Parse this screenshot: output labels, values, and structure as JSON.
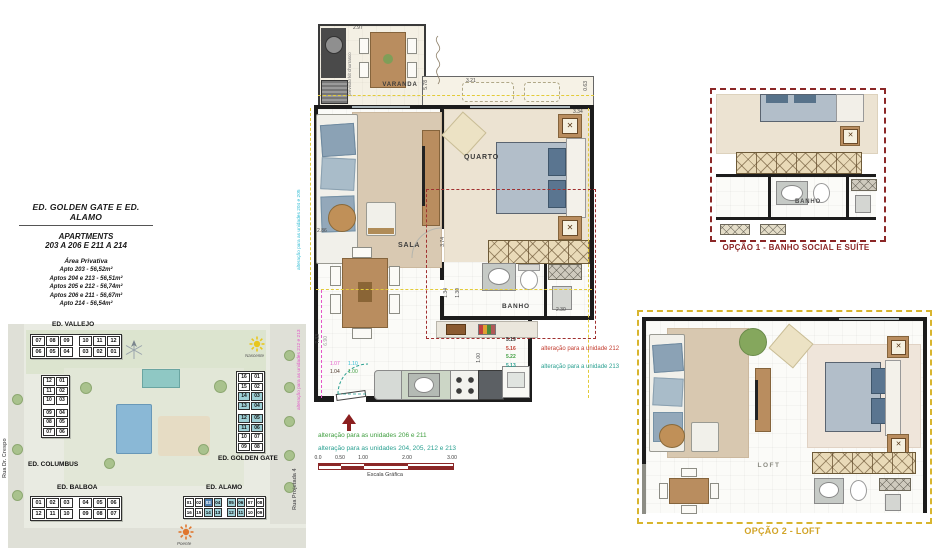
{
  "info_panel": {
    "title": "ED. GOLDEN GATE E ED. ALAMO",
    "subtitle1": "APARTMENTS",
    "subtitle2": "203 A 206 E 211 A 214",
    "area_heading": "Área Privativa",
    "areas": [
      "Apto 203 - 56,52m²",
      "Aptos 204 e 213 - 56,51m²",
      "Aptos 205 e 212 - 56,74m²",
      "Aptos 206 e 211 - 56,67m²",
      "Apto 214 - 56,54m²"
    ]
  },
  "site_map": {
    "street_left": "Rua Dr. Crespo",
    "street_right": "Rua Projetada 4",
    "sun_east": "Nascente",
    "sun_west": "Poente",
    "buildings": {
      "vallejo": {
        "label": "ED. VALLEJO",
        "rows": [
          [
            "07",
            "08",
            "09",
            "10",
            "11",
            "12"
          ],
          [
            "06",
            "05",
            "04",
            "03",
            "02",
            "01"
          ]
        ],
        "hl": [
          [
            0,
            0,
            0,
            0,
            0,
            0
          ],
          [
            0,
            0,
            0,
            0,
            0,
            0
          ]
        ]
      },
      "columbus": {
        "label": "ED. COLUMBUS",
        "pairs": [
          [
            "12",
            "01"
          ],
          [
            "11",
            "02"
          ],
          [
            "10",
            "03"
          ],
          [
            "09",
            "04"
          ],
          [
            "08",
            "05"
          ],
          [
            "07",
            "06"
          ]
        ],
        "hl": [
          [
            0,
            0
          ],
          [
            0,
            0
          ],
          [
            0,
            0
          ],
          [
            0,
            0
          ],
          [
            0,
            0
          ],
          [
            0,
            0
          ]
        ]
      },
      "golden_gate": {
        "label": "ED. GOLDEN GATE",
        "pairs": [
          [
            "16",
            "01"
          ],
          [
            "15",
            "02"
          ],
          [
            "14",
            "03"
          ],
          [
            "13",
            "04"
          ],
          [
            "12",
            "05"
          ],
          [
            "11",
            "06"
          ],
          [
            "10",
            "07"
          ],
          [
            "09",
            "08"
          ]
        ],
        "hl": [
          [
            0,
            0
          ],
          [
            0,
            0
          ],
          [
            1,
            1
          ],
          [
            1,
            1
          ],
          [
            1,
            1
          ],
          [
            1,
            1
          ],
          [
            0,
            0
          ],
          [
            0,
            0
          ]
        ]
      },
      "balboa": {
        "label": "ED. BALBOA",
        "rows": [
          [
            "01",
            "02",
            "03",
            "04",
            "05",
            "06"
          ],
          [
            "12",
            "11",
            "10",
            "09",
            "08",
            "07"
          ]
        ],
        "hl": [
          [
            0,
            0,
            0,
            0,
            0,
            0
          ],
          [
            0,
            0,
            0,
            0,
            0,
            0
          ]
        ]
      },
      "alamo": {
        "label": "ED. ALAMO",
        "rows": [
          [
            "01",
            "02",
            "03",
            "04",
            "05",
            "06",
            "07",
            "08"
          ],
          [
            "16",
            "15",
            "14",
            "13",
            "12",
            "11",
            "10",
            "09"
          ]
        ],
        "hl": [
          [
            0,
            0,
            2,
            1,
            1,
            1,
            0,
            0
          ],
          [
            0,
            0,
            1,
            1,
            1,
            1,
            0,
            0
          ]
        ]
      }
    }
  },
  "floor_plan": {
    "rooms": {
      "varanda": "VARANDA",
      "quarto": "QUARTO",
      "sala": "SALA",
      "banho": "BANHO"
    },
    "note_churrasco": "previsão kit churrasco",
    "dimensions": [
      {
        "t": "2.97",
        "x": 353,
        "y": 26
      },
      {
        "t": "5.78",
        "x": 424,
        "y": 80,
        "r": 1
      },
      {
        "t": "3.21",
        "x": 466,
        "y": 79
      },
      {
        "t": "0.63",
        "x": 584,
        "y": 81,
        "r": 1
      },
      {
        "t": "3.34",
        "x": 573,
        "y": 110
      },
      {
        "t": "3.74",
        "x": 441,
        "y": 237,
        "r": 1
      },
      {
        "t": "2.86",
        "x": 317,
        "y": 229
      },
      {
        "t": "7.33",
        "x": 316,
        "y": 334,
        "r": 1
      },
      {
        "t": "6.90",
        "x": 324,
        "y": 336,
        "r": 1,
        "c": "#9a9a9a"
      },
      {
        "t": "1.34",
        "x": 444,
        "y": 288,
        "r": 1
      },
      {
        "t": "1.30",
        "x": 456,
        "y": 288,
        "r": 1
      },
      {
        "t": "2.30",
        "x": 556,
        "y": 308
      },
      {
        "t": "1.00",
        "x": 477,
        "y": 353,
        "r": 1
      },
      {
        "t": "1.07",
        "x": 330,
        "y": 362,
        "c": "#e356c8"
      },
      {
        "t": "1.10",
        "x": 348,
        "y": 362,
        "c": "#2ebcd4"
      },
      {
        "t": "1.04",
        "x": 330,
        "y": 370,
        "c": "#4a3428"
      },
      {
        "t": "1.00",
        "x": 348,
        "y": 370,
        "c": "#3f9e3f"
      }
    ],
    "stacked_dims": [
      {
        "t": "5.19",
        "c": "#3a3a3a"
      },
      {
        "t": "5.16",
        "c": "#c23b2e"
      },
      {
        "t": "5.22",
        "c": "#3f9e3f"
      },
      {
        "t": "5.13",
        "c": "#2aa091"
      }
    ]
  },
  "annotations": {
    "vertical_cyan": "alteração para as unidades 204 e 205",
    "vertical_magenta": "alteração para as unidades 212 e 213",
    "line_green": "alteração para as unidades 206 e 211",
    "line_teal": "alteração para as unidades 204, 205, 212 e 213",
    "unit_red": "alteração para a unidade 212",
    "unit_teal": "alteração para a unidade 213"
  },
  "options": {
    "option1": {
      "label": "OPÇÃO 1 - BANHO SOCIAL E SUÍTE",
      "room": "BANHO",
      "accent": "#8b2727"
    },
    "option2": {
      "label": "OPÇÃO 2 - LOFT",
      "room": "LOFT",
      "accent": "#d2a427"
    }
  },
  "scale_bar": {
    "label": "Escala Gráfica",
    "ticks": [
      {
        "label": "0.0",
        "x": 0
      },
      {
        "label": "0.50",
        "x": 22
      },
      {
        "label": "1.00",
        "x": 45
      },
      {
        "label": "2.00",
        "x": 89
      },
      {
        "label": "3.00",
        "x": 134
      }
    ]
  }
}
